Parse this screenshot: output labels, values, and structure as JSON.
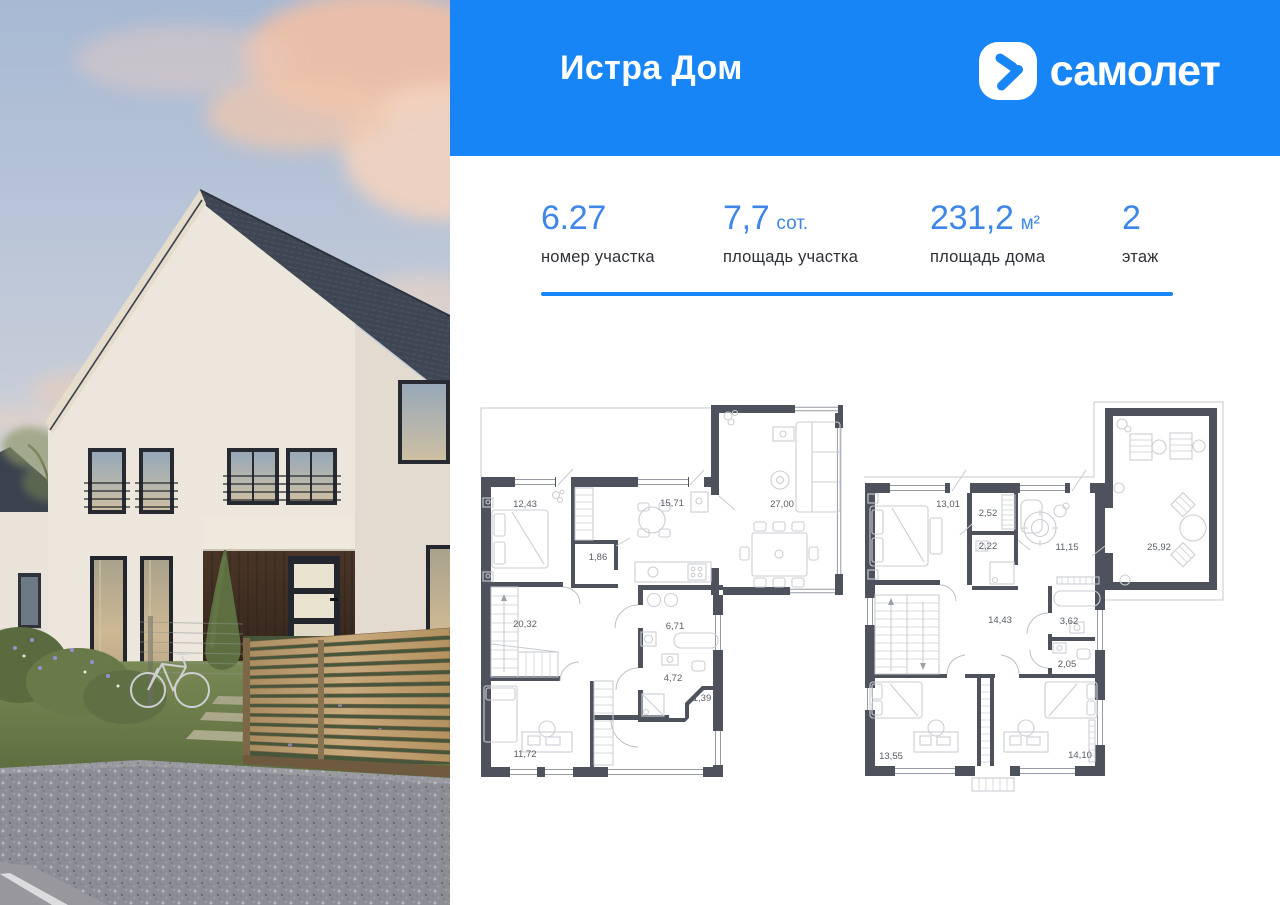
{
  "header": {
    "title": "Истра Дом",
    "brand": "самолет"
  },
  "stats": [
    {
      "value": "6.27",
      "suffix": "",
      "label": "номер участка"
    },
    {
      "value": "7,7",
      "suffix": "сот.",
      "label": "площадь участка"
    },
    {
      "value": "231,2",
      "suffix": "м²",
      "label": "площадь дома"
    },
    {
      "value": "2",
      "suffix": "",
      "label": "этаж"
    }
  ],
  "plans": {
    "floor1": {
      "rooms": [
        {
          "area": "12,43"
        },
        {
          "area": "1,86"
        },
        {
          "area": "15,71"
        },
        {
          "area": "27,00"
        },
        {
          "area": "20,32"
        },
        {
          "area": "6,71"
        },
        {
          "area": "4,72"
        },
        {
          "area": "1,39"
        },
        {
          "area": "11,72"
        }
      ]
    },
    "floor2": {
      "rooms": [
        {
          "area": "13,01"
        },
        {
          "area": "2,52"
        },
        {
          "area": "2,22"
        },
        {
          "area": "11,15"
        },
        {
          "area": "25,92"
        },
        {
          "area": "14,43"
        },
        {
          "area": "3,62"
        },
        {
          "area": "2,05"
        },
        {
          "area": "13,55"
        },
        {
          "area": "14,10"
        }
      ]
    }
  },
  "colors": {
    "brand_blue": "#1785F6",
    "stat_blue": "#3E86E8",
    "plan_wall": "#4D525C"
  }
}
